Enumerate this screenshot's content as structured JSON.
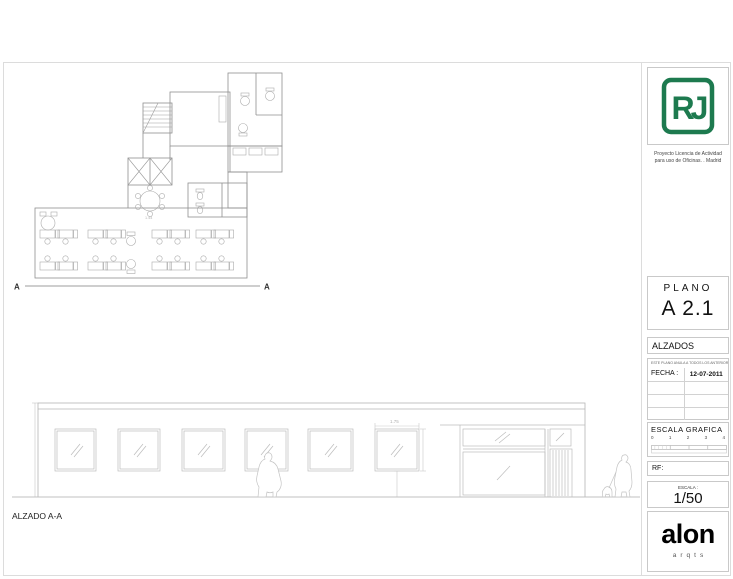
{
  "header": {
    "logo_monogram": "RJ",
    "logo_color": "#1d7a4f",
    "project_line1": "Proyecto Licencia de Actividad",
    "project_line2": "para uso de Oficinas. . Madrid"
  },
  "title_block": {
    "plano_label": "PLANO",
    "plano_code": "A 2.1",
    "sheet_title": "ALZADOS",
    "revision_note": "ESTE PLANO ANULA A TODOS LOS ANTERIORES",
    "fecha_label": "FECHA :",
    "fecha_value": "12-07-2011",
    "escala_grafica_label": "ESCALA GRAFICA",
    "escala_grafica_ticks": [
      "0",
      "1",
      "2",
      "3",
      "4"
    ],
    "rf_label": "RF:",
    "escala_label": "ESCALA :",
    "escala_value": "1/50",
    "firm_name": "alon",
    "firm_subname": "arqts"
  },
  "drawing": {
    "section_marker_left": "A",
    "section_marker_right": "A",
    "elevation_label": "ALZADO A-A",
    "plan_dim": "1.44",
    "window_width_dim": "1.75"
  }
}
